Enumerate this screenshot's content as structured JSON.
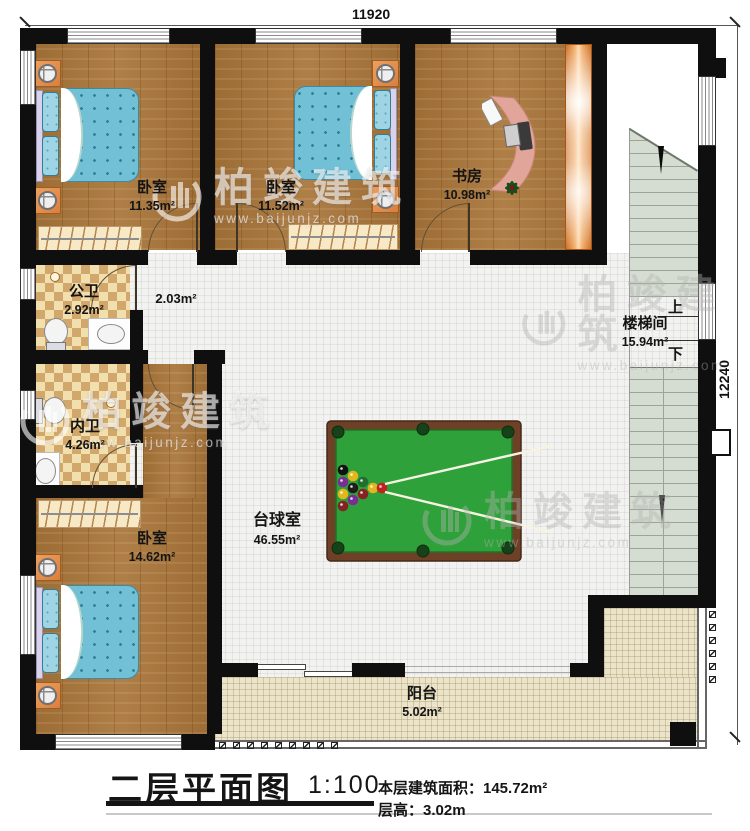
{
  "dimensions": {
    "top": "11920",
    "right": "12240"
  },
  "rooms": {
    "bedroom1": {
      "name": "卧室",
      "area": "11.35m²"
    },
    "bedroom2": {
      "name": "卧室",
      "area": "11.52m²"
    },
    "study": {
      "name": "书房",
      "area": "10.98m²"
    },
    "public_bath": {
      "name": "公卫",
      "area": "2.92m²"
    },
    "hallway": {
      "area": "2.03m²"
    },
    "inner_bath": {
      "name": "内卫",
      "area": "4.26m²"
    },
    "bedroom3": {
      "name": "卧室",
      "area": "14.62m²"
    },
    "billiards": {
      "name": "台球室",
      "area": "46.55m²"
    },
    "stairwell": {
      "name": "楼梯间",
      "area": "15.94m²"
    },
    "balcony": {
      "name": "阳台",
      "area": "5.02m²"
    }
  },
  "stairs": {
    "up": "上",
    "down": "下"
  },
  "title_block": {
    "title": "二层平面图",
    "scale": "1:100",
    "area_label": "本层建筑面积：145.72m²",
    "height_label": "层高：3.02m"
  },
  "watermark": {
    "brand": "柏竣建筑",
    "url": "www.baijunjz.com"
  },
  "colors": {
    "wall": "#0f0f0f",
    "wood_floor": "#a9753a",
    "billiard_felt": "#2fa13a",
    "table_frame": "#6e4126",
    "balcony_tile": "#ebe4ca",
    "bed": "#72c0d6"
  }
}
